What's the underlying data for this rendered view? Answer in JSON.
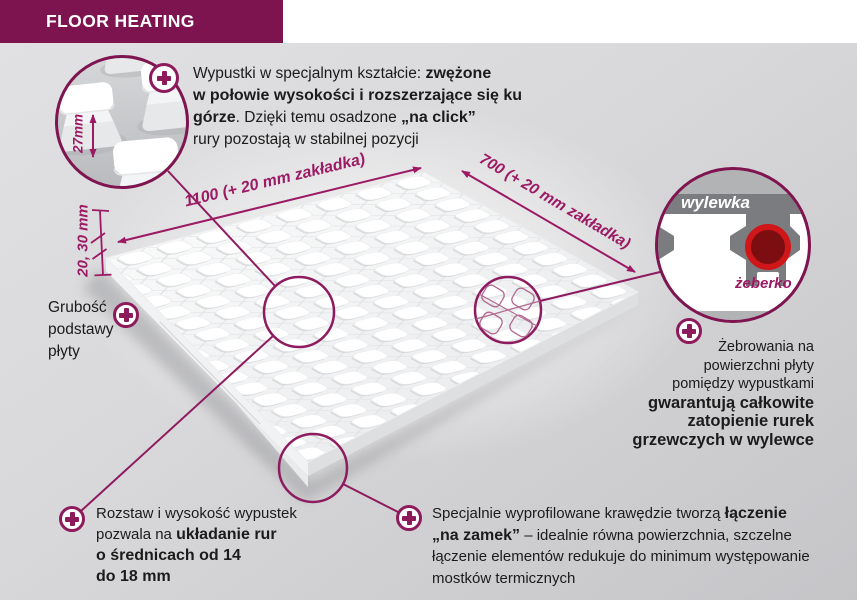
{
  "header": {
    "title": "FLOOR HEATING"
  },
  "callouts": {
    "nubs": {
      "l1a": "Wypustki w specjalnym kształcie: ",
      "l1b": "zwężone",
      "l2b": "w połowie wysokości i rozszerzające się ku",
      "l3b1": "górze",
      "l3a": ". Dzięki temu osadzone ",
      "l3b2": "„na click”",
      "l4": "rury pozostają w stabilnej pozycji"
    },
    "ribbing": {
      "l1": "Żebrowania na",
      "l2": "powierzchni płyty",
      "l3": "pomiędzy wypustkami",
      "l4": "gwarantują całkowite",
      "l5": "zatopienie rurek",
      "l6": "grzewczych w wylewce"
    },
    "spacing": {
      "l1": "Rozstaw i wysokość wypustek",
      "l2a": "pozwala na ",
      "l2b": "układanie rur",
      "l3": "o średnicach od 14",
      "l4": "do 18 mm"
    },
    "lock": {
      "l1a": "Specjalnie wyprofilowane krawędzie tworzą ",
      "l1b": "łączenie",
      "l2b": "„na zamek”",
      "l2a": " – idealnie równa powierzchnia, szczelne",
      "l3": "łączenie elementów redukuje do minimum występowanie",
      "l4": "mostków termicznych"
    },
    "thickness": {
      "l1": "Grubość",
      "l2": "podstawy",
      "l3": "płyty"
    }
  },
  "dimensions": {
    "nub_height": "27mm",
    "base_thickness": "20, 30 mm",
    "panel_length": "1100 (+ 20 mm zakładka)",
    "panel_width": "700 (+ 20 mm zakładka)"
  },
  "inset": {
    "screed_label": "wylewka",
    "rib_label": "żeberko"
  },
  "icons": {
    "marker": "plus-icon"
  },
  "colors": {
    "header_bg": "#7d1450",
    "accent": "#9c1a64",
    "icon": "#8d1a5b",
    "pipe_ring": "#cf1619",
    "pipe_fill": "#7c0e11",
    "screed_gray": "#7b7c7f",
    "band_gray": "#b2b3b5"
  }
}
